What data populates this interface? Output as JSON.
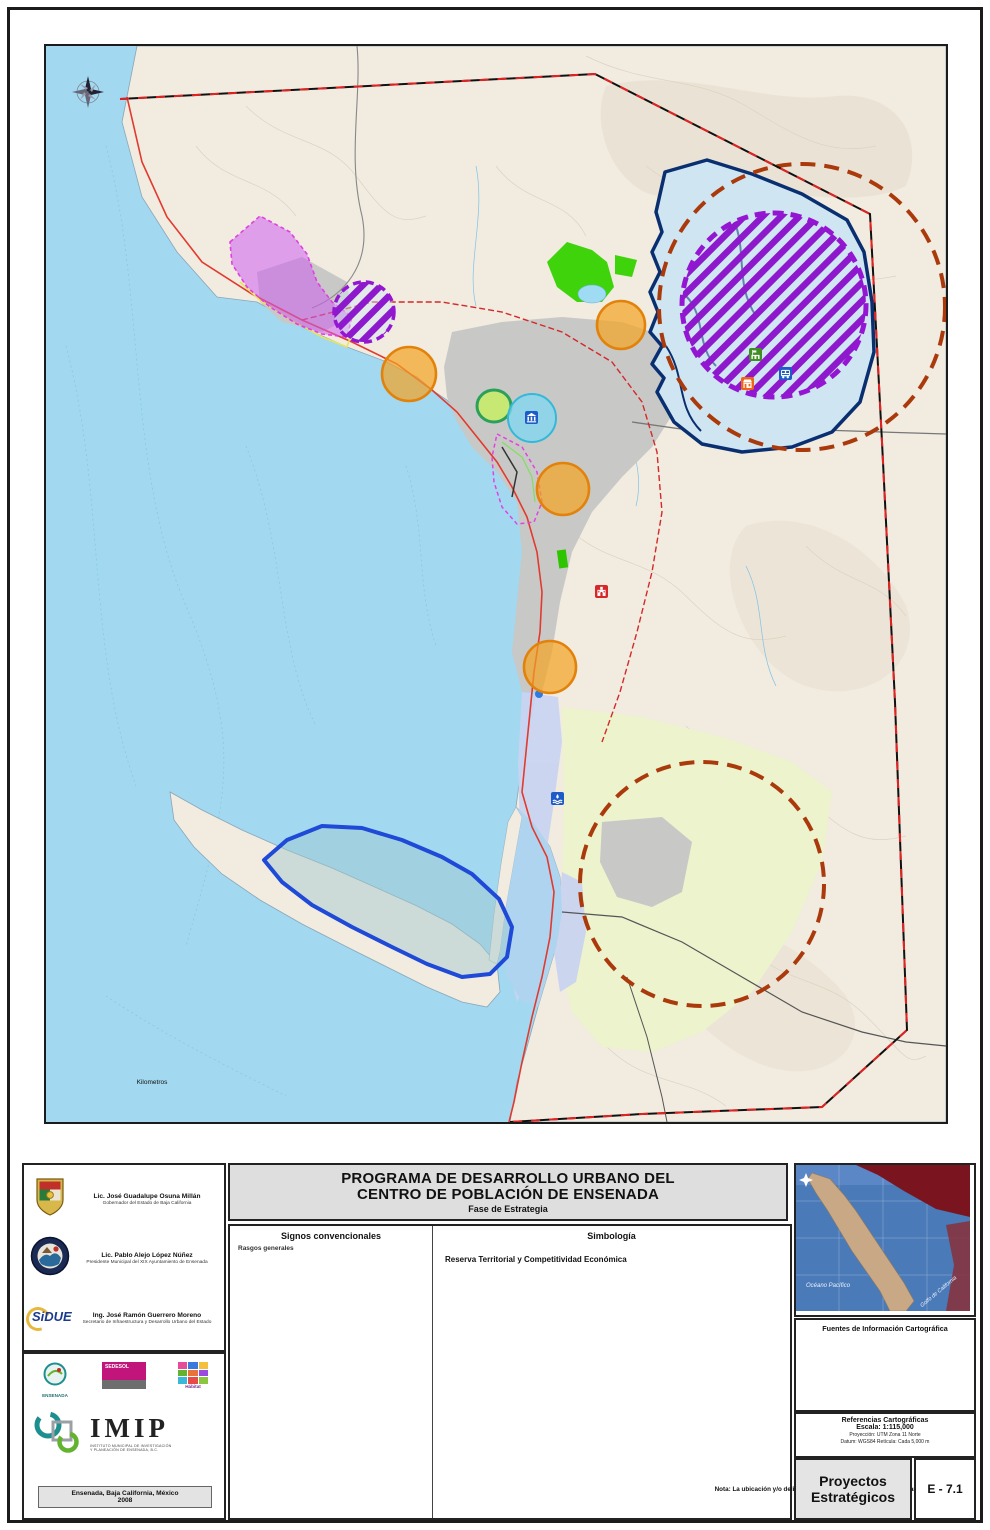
{
  "title_block": {
    "line1": "PROGRAMA DE DESARROLLO URBANO DEL",
    "line2": "CENTRO DE POBLACIÓN DE ENSENADA",
    "subtitle": "Fase de Estrategia"
  },
  "signos": {
    "header": "Signos convencionales",
    "sections": [
      {
        "title": "Rasgos generales",
        "items": [
          {
            "label": "Curvas topográficas acotadas en metros",
            "swatch": "sw-line sw-contour"
          },
          {
            "label": "Curvas batimétricas acotadas en metros",
            "swatch": "sw-line sw-bathy"
          },
          {
            "label": "Hidrología superficial",
            "swatch": "sw-line sw-hydro"
          }
        ]
      },
      {
        "title": "Vías terrestres",
        "items": [
          {
            "label": "Carretera",
            "swatch": "sw-line sw-carretera"
          },
          {
            "label": "Terracería",
            "swatch": "sw-line sw-terraceria"
          },
          {
            "label": "Brechas",
            "swatch": "sw-line sw-brechas"
          },
          {
            "label": "Vereda",
            "swatch": "sw-line sw-vereda"
          },
          {
            "label": "Libramiento propuesto",
            "swatch": "sw-line sw-libramiento"
          }
        ]
      },
      {
        "title": "Límites simbolizados",
        "items": [
          {
            "label": "Centro de Población",
            "swatch": "sw-line sw-centro"
          },
          {
            "label": "Área de Estudio",
            "swatch": "sw-estudio"
          },
          {
            "label": "Sectores",
            "swatch": "sw-line sw-sectores"
          },
          {
            "label": "Puerto de Ensenada",
            "swatch": "sw-line sw-pensenada"
          },
          {
            "label": "Ampliación Puerto de Ensenada",
            "swatch": "sw-line sw-ampliacion"
          },
          {
            "label": "Puerto de El Sauzal",
            "swatch": "sw-line sw-psauzal"
          }
        ]
      },
      {
        "title": "Áreas simbolizadas",
        "items": [
          {
            "label": "Zona urbana actual",
            "swatch": "sw-area sw-urbana"
          },
          {
            "label": "Zona de inundación",
            "swatch": "sw-area sw-inundacion"
          },
          {
            "label": "Zona agrícola",
            "swatch": "sw-area sw-agricola"
          },
          {
            "label": "Propuesta de Reserva",
            "swatch": "sw-area sw-reserva"
          },
          {
            "label": "La Lagunita del Naranjo",
            "swatch": "sw-area sw-lagunita"
          },
          {
            "label": "Presa Emilio López Zamora",
            "swatch": "sw-area sw-presa"
          }
        ]
      }
    ]
  },
  "simbologia": {
    "header": "Simbología",
    "subheader": "Reserva Territorial y Competitividad Económica",
    "left_items": [
      {
        "label": "Teleférico",
        "swatch": "sy-teleferico",
        "big": true
      },
      {
        "label": "Cluster turístico cultural de Ensenada",
        "swatch": "sy-cluster",
        "big": true
      },
      {
        "label": "Adquisición y habilitación de reservas para uso industrial",
        "swatch": "sy-industrial",
        "big": true
      },
      {
        "label": "Fideicomiso para adquisición de reservas territoriales",
        "swatch": "sy-fideicomiso",
        "big": true
      },
      {
        "label": "Programa de urbanización de lotes baldíos",
        "swatch": "sy-lotes",
        "big": true
      },
      {
        "label": "Zona de Desarrollo Portuario",
        "swatch": "sy-portuario",
        "big": false
      },
      {
        "label": "Infraestructura hidráulica y sanitaria",
        "swatch": "sy-infra",
        "big": false
      },
      {
        "label": "Infraestructura hidráulica y sanitaria (arriba cota de los 200 msnm)",
        "swatch": "sy-infra200",
        "big": false
      }
    ],
    "right_items": [
      {
        "label": "Campus UABC Noreste",
        "icon": "ic-campus"
      },
      {
        "label": "Central de Abasto",
        "icon": "ic-abasto"
      },
      {
        "label": "Centro de Convenciones",
        "icon": "ic-convenciones"
      },
      {
        "label": "Palacio Municipal",
        "icon": "ic-palacio"
      },
      {
        "label": "Terminal de Transporte Foráneo",
        "icon": "ic-terminal"
      },
      {
        "label": "Desaladora",
        "icon": "ic-desaladora"
      }
    ],
    "note": "Nota: La ubicación y/o delimitación de las estrategias es preliminar y puede variar en el proyecto final."
  },
  "officials": [
    {
      "name": "Lic. José Guadalupe Osuna Millán",
      "title": "Gobernador del Estado de Baja California"
    },
    {
      "name": "Lic. Pablo Alejo López Núñez",
      "title": "Presidente Municipal del XIX Ayuntamiento de Ensenada"
    },
    {
      "name": "Ing. José Ramón Guerrero Moreno",
      "title": "Secretario de Infraestructura y Desarrollo Urbano del Estado",
      "logo_text": "SiDUE"
    }
  ],
  "credits": {
    "logo_ensenada": "ENSENADA",
    "logo_sedesol": "SEDESOL",
    "logo_habitat": "Hábitat",
    "imip_acronym": "IMIP",
    "imip_caption1": "INSTITUTO MUNICIPAL DE INVESTIGACIÓN",
    "imip_caption2": "Y PLANEACIÓN DE ENSENADA, B.C.",
    "footer_line1": "Ensenada, Baja California, México",
    "footer_line2": "2008"
  },
  "fuentes": {
    "header": "Fuentes de Información Cartográfica",
    "lines": [
      "Instituto Nacional de Estadística,",
      "Geografía e Informática - INEGI",
      "Comisión Nacional para el Conocimiento",
      "y Uso de la Biodiversidad - CONABIO",
      "Gobierno Estatal y Municipal",
      "Instituto Municipal de Investigación",
      "y Planeación, BC - IMIP",
      "Environmental Systems Research Institute, Inc - ESRI"
    ]
  },
  "referencias": {
    "header": "Referencias Cartográficas",
    "escala": "Escala: 1:115,000",
    "proyeccion": "Proyección: UTM Zona 11 Norte",
    "datum": "Datum: WGS84     Retícula: Cada 5,000 m"
  },
  "sheet": {
    "name": "Proyectos Estratégicos",
    "code": "E - 7.1"
  },
  "locator": {
    "ocean_label": "Océano Pacífico",
    "gulf_label": "Golfo de California"
  },
  "map": {
    "labels": [
      {
        "text": "Playa Saldamando",
        "x": 52,
        "y": 126,
        "size": 7,
        "cls": "coast"
      },
      {
        "text": "Punta San Miguel",
        "x": 98,
        "y": 243,
        "size": 7,
        "cls": "coast"
      },
      {
        "text": "Puerto El Sauzal",
        "x": 174,
        "y": 258,
        "size": 7,
        "cls": "coast"
      },
      {
        "text": "Punta Morro",
        "x": 286,
        "y": 357,
        "size": 7,
        "cls": "coast"
      },
      {
        "text": "Puerto Ensenada",
        "x": 409,
        "y": 420,
        "size": 7,
        "cls": "coast"
      },
      {
        "text": "Playa Municipal",
        "x": 476,
        "y": 508,
        "size": 7,
        "cls": "coast"
      },
      {
        "text": "Playa Monalisa",
        "x": 418,
        "y": 632,
        "size": 7,
        "cls": "coast"
      },
      {
        "text": "Bahía Todos Santos",
        "x": 194,
        "y": 516,
        "size": 17,
        "cls": "sea"
      },
      {
        "text": "Océano Pacífico",
        "x": 28,
        "y": 910,
        "size": 17,
        "cls": "sea"
      },
      {
        "text": "La Bufadora",
        "x": 140,
        "y": 843,
        "size": 7,
        "cls": "coast"
      },
      {
        "text": "Estero de Punta Banda",
        "x": 440,
        "y": 834,
        "size": 7,
        "cls": "estero",
        "rotate": 70
      },
      {
        "text": "Península de Punta Banda",
        "x": 138,
        "y": 764,
        "size": 7.5,
        "cls": "land",
        "rotate": 28
      }
    ],
    "scalebar": {
      "title": "Kilometros",
      "ticks": [
        {
          "t": "0",
          "x": 6
        },
        {
          "t": "0.5",
          "x": 26
        },
        {
          "t": "1",
          "x": 46
        },
        {
          "t": "2",
          "x": 86
        },
        {
          "t": "3",
          "x": 126
        },
        {
          "t": "4",
          "x": 166
        },
        {
          "t": "5",
          "x": 206
        }
      ]
    },
    "graticule": {
      "lon": [
        {
          "t": "116°45'0\"W",
          "x": 150
        },
        {
          "t": "116°40'0\"W",
          "x": 388
        },
        {
          "t": "116°35'0\"W",
          "x": 627
        },
        {
          "t": "116°30'0\"W",
          "x": 866
        }
      ],
      "lat": [
        {
          "t": "31°55'0\"N",
          "y": 222
        },
        {
          "t": "31°50'0\"N",
          "y": 480
        },
        {
          "t": "31°45'0\"N",
          "y": 770
        },
        {
          "t": "31°40'0\"N",
          "y": 1058
        }
      ],
      "utm_e": [
        {
          "t": "525000",
          "x": 185
        },
        {
          "t": "530000",
          "x": 338
        },
        {
          "t": "535000",
          "x": 490
        },
        {
          "t": "540000",
          "x": 643
        },
        {
          "t": "545000",
          "x": 796
        }
      ],
      "utm_n": [
        {
          "t": "3540000",
          "y": 156
        },
        {
          "t": "3535000",
          "y": 308
        },
        {
          "t": "3530000",
          "y": 460
        },
        {
          "t": "3525000",
          "y": 612
        },
        {
          "t": "3520000",
          "y": 764
        },
        {
          "t": "3515000",
          "y": 916
        },
        {
          "t": "3510000",
          "y": 1068
        }
      ]
    },
    "colors": {
      "ocean": "#a2d8f0",
      "land": "#f1ebe0",
      "urban": "#c8c8c6",
      "flood": "#c9d4f1",
      "agricultural": "#ecf3cd",
      "reserve": "#3fd30c",
      "industrial_hatch": "#8d18cc",
      "fideicomiso": "#aa3a0c",
      "lotes": "#f3a321",
      "navy_infra": "#0a2f70",
      "road_red": "#e23a2e",
      "boundary_red": "#dd2222",
      "portuario": "#d964ea"
    }
  }
}
